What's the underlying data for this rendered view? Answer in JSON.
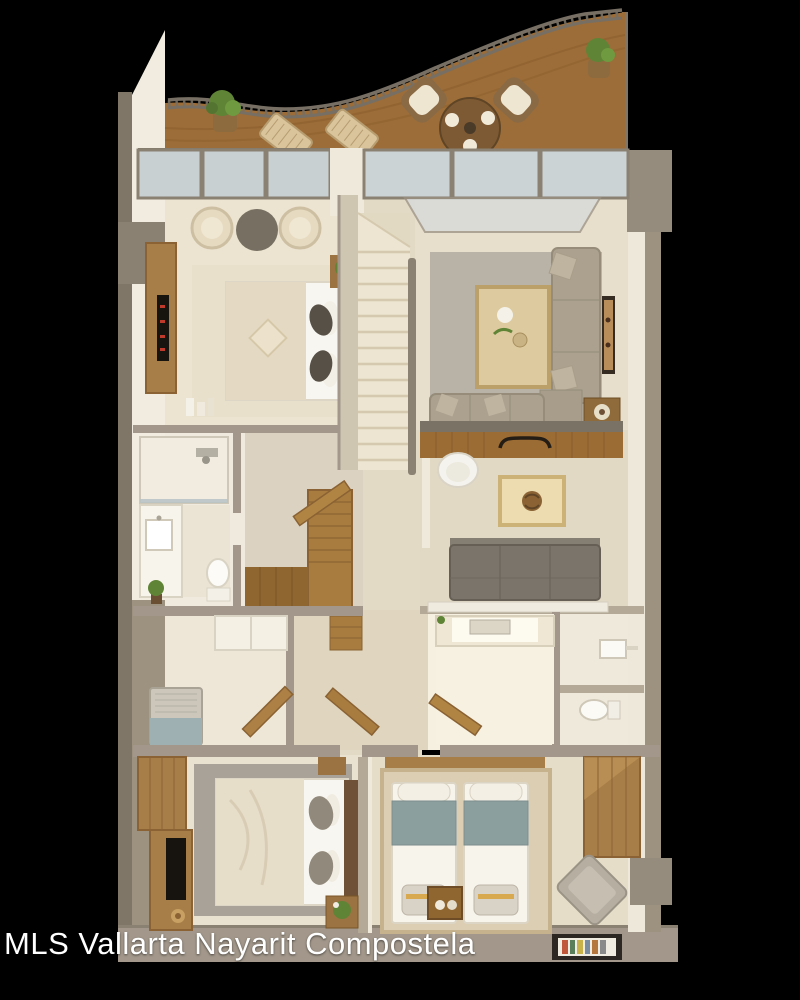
{
  "caption": {
    "text": "MLS Vallarta Nayarit Compostela",
    "color": "#ffffff"
  },
  "scene": {
    "type": "3d-floor-plan-render-top-view",
    "background": "#000000",
    "rooms": [
      {
        "name": "terrace",
        "features": [
          "curved-railing",
          "wood-deck",
          "lounge-chair",
          "lounge-chair",
          "round-dining-table",
          "patio-armchair",
          "patio-armchair",
          "potted-plant",
          "potted-plant"
        ]
      },
      {
        "name": "master-bedroom",
        "features": [
          "double-bed",
          "round-armchair",
          "round-armchair",
          "round-side-table",
          "tv-console",
          "tv",
          "nightstand-plant",
          "rug"
        ]
      },
      {
        "name": "living-room",
        "features": [
          "sectional-sofa",
          "wood-coffee-table",
          "gray-rug",
          "wall-art",
          "side-table",
          "glass-doors"
        ]
      },
      {
        "name": "staircase",
        "features": [
          "upper-flight",
          "handrail",
          "lower-wood-flight",
          "wood-landing"
        ]
      },
      {
        "name": "master-bathroom",
        "features": [
          "walk-in-shower",
          "vanity-sink",
          "toilet",
          "plant"
        ]
      },
      {
        "name": "family-room",
        "features": [
          "wood-bar-desk",
          "desk-chair",
          "square-wood-table",
          "three-seat-sofa"
        ]
      },
      {
        "name": "kitchen",
        "features": [
          "counter-with-sink",
          "open-wood-door"
        ]
      },
      {
        "name": "guest-bathroom",
        "features": [
          "wall-sink",
          "toilet"
        ]
      },
      {
        "name": "utility-room",
        "features": [
          "washing-machine",
          "closet-doors",
          "open-wood-door"
        ]
      },
      {
        "name": "second-bedroom",
        "features": [
          "double-bed",
          "wardrobe",
          "tv-desk",
          "tv",
          "gray-rug",
          "nightstand-plant"
        ]
      },
      {
        "name": "third-bedroom",
        "features": [
          "twin-bed",
          "twin-bed",
          "wood-nightstand",
          "wardrobe",
          "armchair",
          "beige-rug",
          "picture-frame-on-floor"
        ]
      }
    ],
    "palette": {
      "background": "#000000",
      "deck_wood": "#9c6d38",
      "furniture_wood": "#a87e48",
      "wall_white": "#f1ecdf",
      "wall_tan": "#a2978a",
      "floor_cream": "#e8e0cd",
      "rug_gray": "#b5afa4",
      "sofa_taupe": "#aba18e",
      "sofa_gray": "#7b746a",
      "blanket_teal": "#8c9f9f",
      "glass": "#ccd3d5",
      "plant_green": "#5f8436",
      "tv_black": "#17130e",
      "caption_white": "#ffffff"
    }
  }
}
